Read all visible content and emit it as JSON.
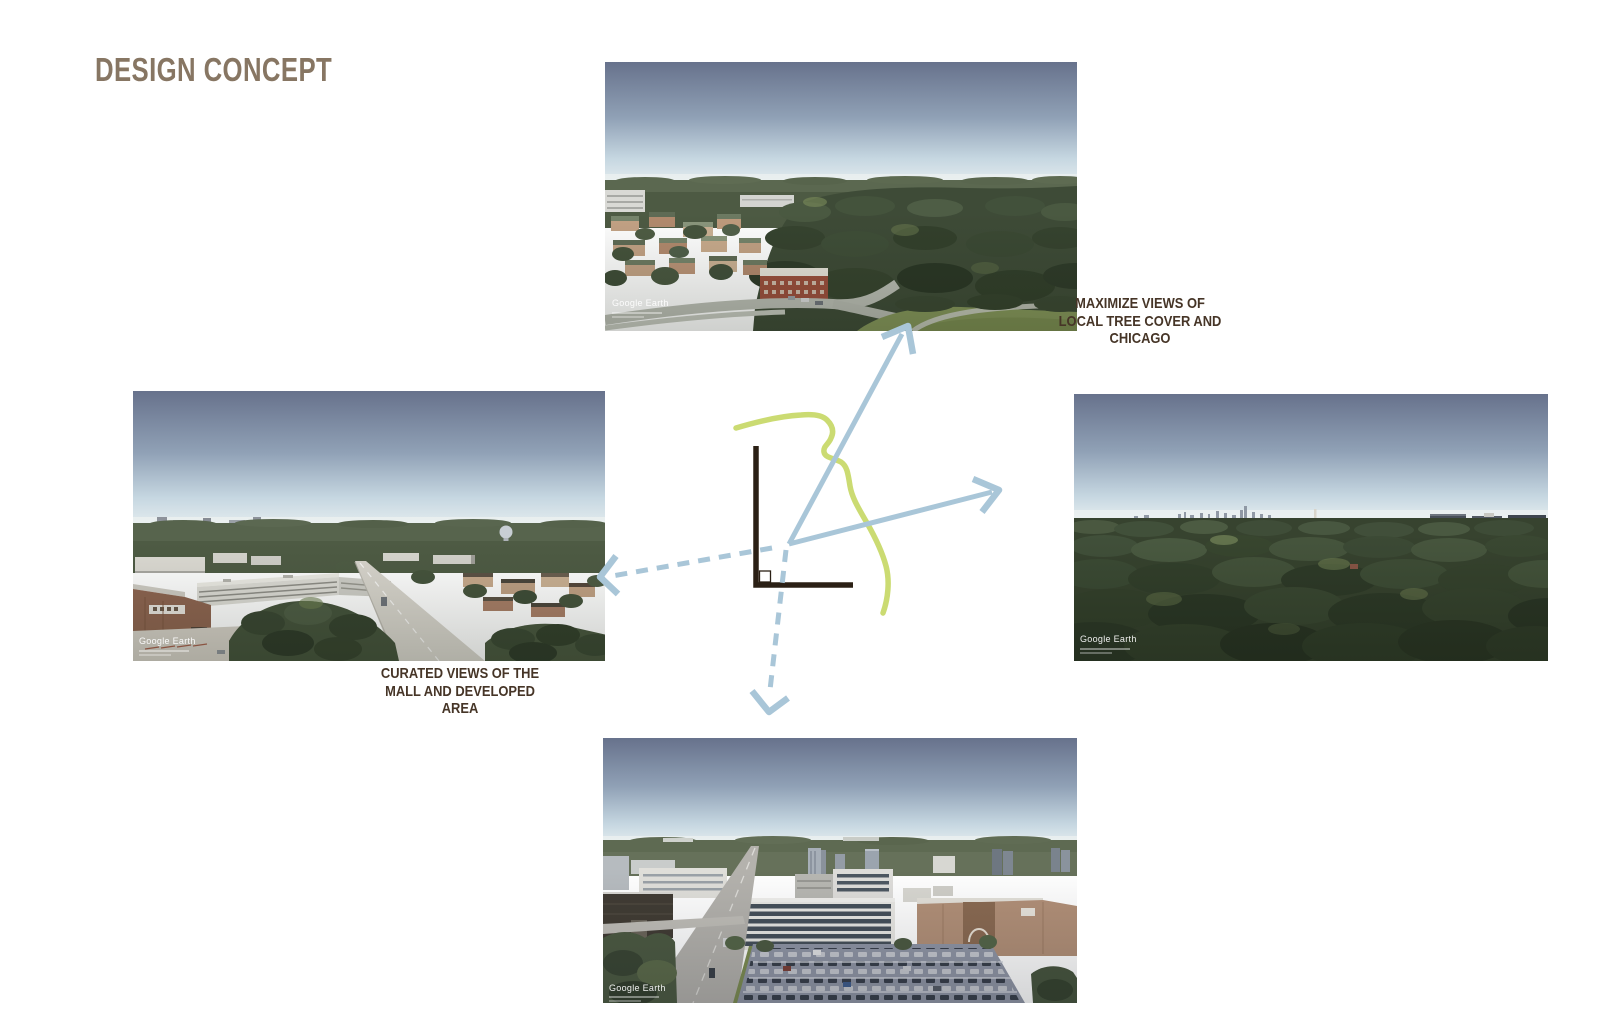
{
  "slide": {
    "title": "DESIGN CONCEPT"
  },
  "labels": {
    "maximize": {
      "lines": [
        "MAXIMIZE VIEWS OF",
        "LOCAL TREE COVER AND",
        "CHICAGO"
      ]
    },
    "curated": {
      "lines": [
        "CURATED VIEWS OF THE",
        "MALL AND DEVELOPED",
        "AREA"
      ]
    }
  },
  "photos": {
    "top": {
      "watermark": "Google Earth",
      "content": "aerial view of suburban tree cover with low-rise buildings"
    },
    "left": {
      "watermark": "Google Earth",
      "content": "aerial view of mall parking garage and developed area"
    },
    "right": {
      "watermark": "Google Earth",
      "content": "aerial view of dense tree canopy with distant Chicago skyline"
    },
    "bottom": {
      "watermark": "Google Earth",
      "content": "aerial view of office buildings, towers and parking lots"
    }
  },
  "diagram": {
    "site_outline": "L-shaped site plan corner",
    "green_line": "meandering landscape path",
    "arrows": [
      {
        "target": "top-photo",
        "style": "solid"
      },
      {
        "target": "right-photo",
        "style": "solid"
      },
      {
        "target": "left-photo",
        "style": "dashed"
      },
      {
        "target": "bottom-photo",
        "style": "dashed"
      }
    ]
  },
  "colors": {
    "title_text": "#877663",
    "label_text": "#463527",
    "arrow_blue": "#a9c6d8",
    "path_green": "#cbdb72",
    "site_outline": "#2b2015"
  }
}
